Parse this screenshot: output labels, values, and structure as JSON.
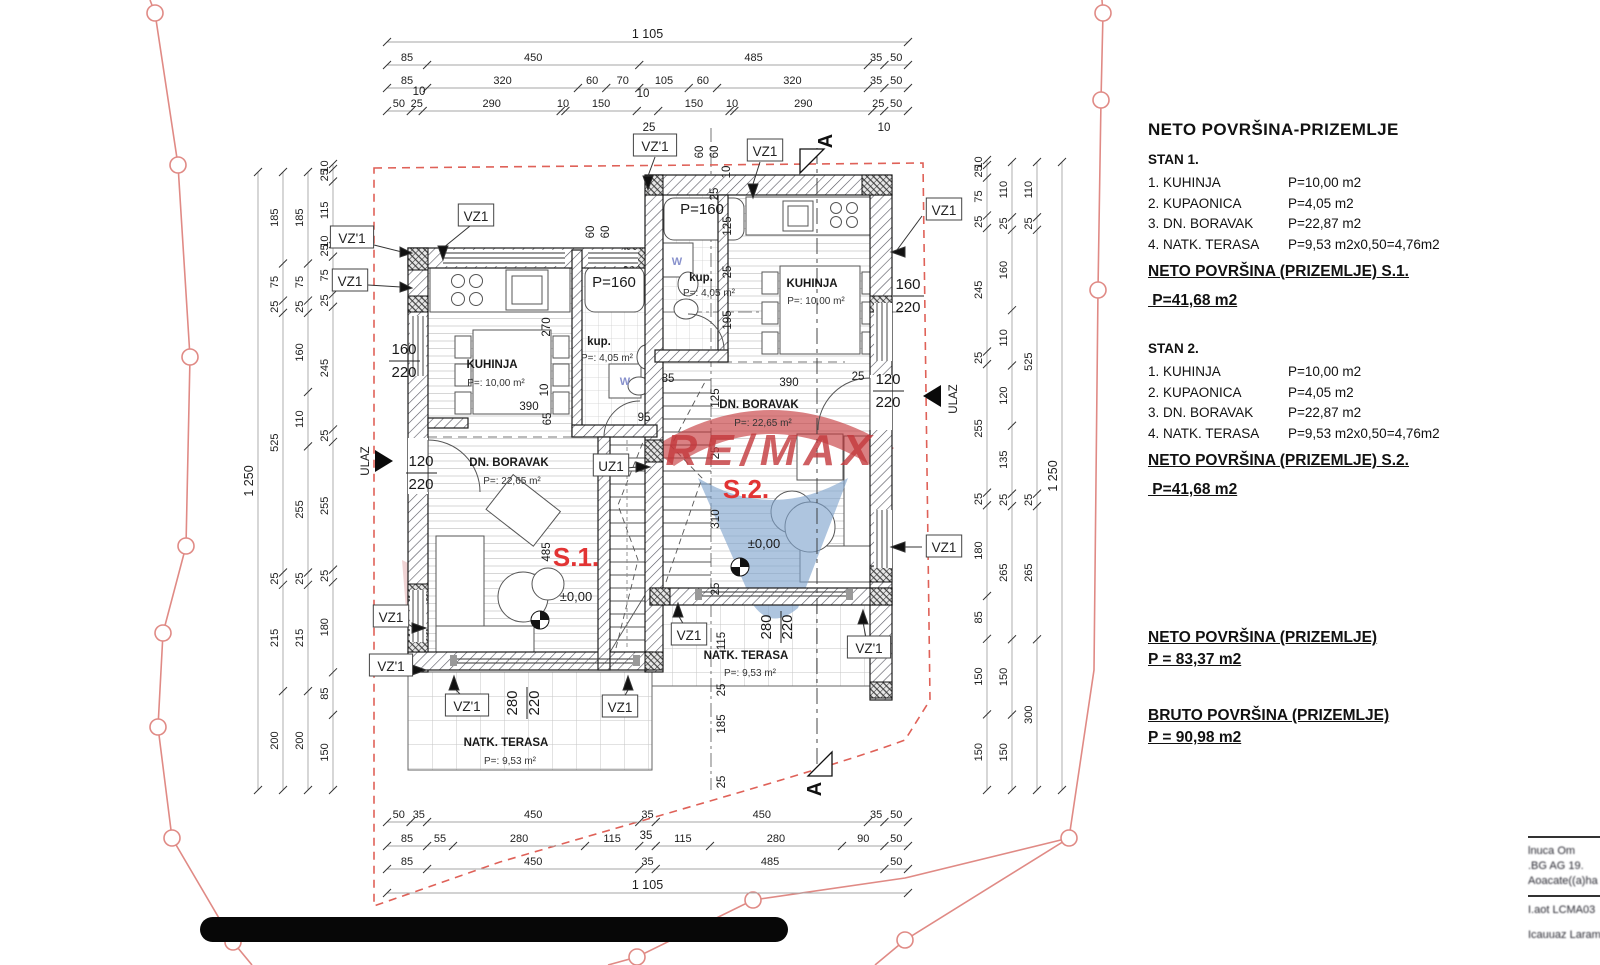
{
  "panel": {
    "heading": "NETO  POVRŠINA-PRIZEMLJE",
    "stan1": {
      "title": "STAN 1.",
      "rows": [
        {
          "name": "1. KUHINJA",
          "value": "P=10,00 m2"
        },
        {
          "name": "2. KUPAONICA",
          "value": "P=4,05 m2"
        },
        {
          "name": "3. DN. BORAVAK",
          "value": "P=22,87 m2"
        },
        {
          "name": "4. NATK. TERASA",
          "value": "P=9,53 m2x0,50=4,76m2"
        }
      ],
      "sum_label": "NETO POVRŠINA (PRIZEMLJE) S.1.",
      "sum_value": " P=41,68 m2"
    },
    "stan2": {
      "title": "STAN 2.",
      "rows": [
        {
          "name": "1. KUHINJA",
          "value": "P=10,00 m2"
        },
        {
          "name": "2. KUPAONICA",
          "value": "P=4,05 m2"
        },
        {
          "name": "3. DN. BORAVAK",
          "value": "P=22,87 m2"
        },
        {
          "name": "4. NATK. TERASA",
          "value": "P=9,53 m2x0,50=4,76m2"
        }
      ],
      "sum_label": "NETO POVRŠINA (PRIZEMLJE) S.2.",
      "sum_value": " P=41,68 m2"
    },
    "neto_total": {
      "label": "NETO POVRŠINA (PRIZEMLJE)",
      "value": "P = 83,37 m2"
    },
    "bruto_total": {
      "label": "BRUTO POVRŠINA (PRIZEMLJE)",
      "value": "P = 90,98 m2"
    }
  },
  "titleblock": {
    "lines": [
      "lnuca  Om",
      ".BG AG 19.",
      "Aoacate((a)ha",
      "I.aot LCMA03",
      "Icauuaz  Laram"
    ]
  },
  "watermark": {
    "text": "RE/MAX",
    "red": "#c4393c",
    "blue": "#7fa3cd"
  },
  "plan_labels": [
    {
      "t": "VZ'1",
      "x": 352,
      "y": 238,
      "c": "box"
    },
    {
      "t": "VZ1",
      "x": 350,
      "y": 281,
      "c": "box"
    },
    {
      "t": "VZ1",
      "x": 476,
      "y": 216,
      "c": "box"
    },
    {
      "t": "VZ'1",
      "x": 655,
      "y": 146,
      "c": "box"
    },
    {
      "t": "VZ1",
      "x": 765,
      "y": 151,
      "c": "box"
    },
    {
      "t": "VZ1",
      "x": 944,
      "y": 210,
      "c": "box"
    },
    {
      "t": "VZ1",
      "x": 944,
      "y": 547,
      "c": "box"
    },
    {
      "t": "VZ1",
      "x": 391,
      "y": 617,
      "c": "box"
    },
    {
      "t": "VZ'1",
      "x": 391,
      "y": 666,
      "c": "box"
    },
    {
      "t": "VZ'1",
      "x": 467,
      "y": 706,
      "c": "box"
    },
    {
      "t": "VZ1",
      "x": 620,
      "y": 707,
      "c": "box"
    },
    {
      "t": "VZ1",
      "x": 689,
      "y": 635,
      "c": "box"
    },
    {
      "t": "VZ'1",
      "x": 869,
      "y": 648,
      "c": "box"
    },
    {
      "t": "UZ1",
      "x": 611,
      "y": 466,
      "c": "box"
    },
    {
      "t": "KUHINJA",
      "x": 492,
      "y": 368,
      "c": "room"
    },
    {
      "t": "P=: 10,00 m²",
      "x": 496,
      "y": 386,
      "c": "small"
    },
    {
      "t": "KUHINJA",
      "x": 812,
      "y": 287,
      "c": "room"
    },
    {
      "t": "P=: 10,00 m²",
      "x": 816,
      "y": 304,
      "c": "small"
    },
    {
      "t": "kup.",
      "x": 599,
      "y": 345,
      "c": "room"
    },
    {
      "t": "P=: 4,05 m²",
      "x": 607,
      "y": 361,
      "c": "small"
    },
    {
      "t": "kup.",
      "x": 701,
      "y": 281,
      "c": "room"
    },
    {
      "t": "P=: 4,05 m²",
      "x": 709,
      "y": 296,
      "c": "small"
    },
    {
      "t": "DN. BORAVAK",
      "x": 509,
      "y": 466,
      "c": "room"
    },
    {
      "t": "P=:   22,65 m²",
      "x": 512,
      "y": 484,
      "c": "small"
    },
    {
      "t": "DN. BORAVAK",
      "x": 759,
      "y": 408,
      "c": "room"
    },
    {
      "t": "P=:    22,65 m²",
      "x": 763,
      "y": 426,
      "c": "small"
    },
    {
      "t": "NATK. TERASA",
      "x": 506,
      "y": 746,
      "c": "room"
    },
    {
      "t": "P=:      9,53 m²",
      "x": 510,
      "y": 764,
      "c": "small"
    },
    {
      "t": "NATK. TERASA",
      "x": 746,
      "y": 659,
      "c": "room"
    },
    {
      "t": "P=:      9,53 m²",
      "x": 750,
      "y": 676,
      "c": "small"
    },
    {
      "t": "P=160",
      "x": 614,
      "y": 287,
      "c": "frac"
    },
    {
      "t": "P=160",
      "x": 702,
      "y": 214,
      "c": "frac"
    },
    {
      "t": "±0,00",
      "x": 576,
      "y": 601,
      "c": "level"
    },
    {
      "t": "±0,00",
      "x": 764,
      "y": 548,
      "c": "level"
    },
    {
      "t": "S.1.",
      "x": 576,
      "y": 566,
      "c": "red"
    },
    {
      "t": "S.2.",
      "x": 746,
      "y": 498,
      "c": "red"
    },
    {
      "t": "60",
      "x": 594,
      "y": 232,
      "r": -90,
      "c": "dim"
    },
    {
      "t": "60",
      "x": 609,
      "y": 232,
      "r": -90,
      "c": "dim"
    },
    {
      "t": "60",
      "x": 703,
      "y": 152,
      "r": -90,
      "c": "dim"
    },
    {
      "t": "60",
      "x": 718,
      "y": 152,
      "r": -90,
      "c": "dim"
    },
    {
      "t": "10",
      "x": 730,
      "y": 172,
      "r": -90,
      "c": "dim"
    },
    {
      "t": "25",
      "x": 718,
      "y": 194,
      "r": -90,
      "c": "dim"
    },
    {
      "t": "270",
      "x": 550,
      "y": 327,
      "r": -90,
      "c": "dim"
    },
    {
      "t": "10",
      "x": 548,
      "y": 390,
      "r": -90,
      "c": "dim"
    },
    {
      "t": "390",
      "x": 529,
      "y": 410,
      "c": "dim"
    },
    {
      "t": "65",
      "x": 551,
      "y": 419,
      "r": -90,
      "c": "dim"
    },
    {
      "t": "125",
      "x": 731,
      "y": 226,
      "r": -90,
      "c": "dim"
    },
    {
      "t": "25",
      "x": 731,
      "y": 272,
      "r": -90,
      "c": "dim"
    },
    {
      "t": "195",
      "x": 731,
      "y": 320,
      "r": -90,
      "c": "dim"
    },
    {
      "t": "85",
      "x": 668,
      "y": 382,
      "c": "dim"
    },
    {
      "t": "95",
      "x": 644,
      "y": 421,
      "c": "dim"
    },
    {
      "t": "390",
      "x": 789,
      "y": 386,
      "c": "dim"
    },
    {
      "t": "25",
      "x": 858,
      "y": 380,
      "c": "dim"
    },
    {
      "t": "125",
      "x": 719,
      "y": 398,
      "r": -90,
      "c": "dim"
    },
    {
      "t": "25",
      "x": 719,
      "y": 453,
      "r": -90,
      "c": "dim"
    },
    {
      "t": "310",
      "x": 719,
      "y": 519,
      "r": -90,
      "c": "dim"
    },
    {
      "t": "25",
      "x": 719,
      "y": 589,
      "r": -90,
      "c": "dim"
    },
    {
      "t": "485",
      "x": 550,
      "y": 552,
      "r": -90,
      "c": "dim"
    },
    {
      "t": "115",
      "x": 725,
      "y": 641,
      "r": -90,
      "c": "dim"
    },
    {
      "t": "25",
      "x": 725,
      "y": 690,
      "r": -90,
      "c": "dim"
    },
    {
      "t": "185",
      "x": 725,
      "y": 724,
      "r": -90,
      "c": "dim"
    },
    {
      "t": "25",
      "x": 725,
      "y": 782,
      "r": -90,
      "c": "dim"
    },
    {
      "t": "280",
      "x": 517,
      "y": 703,
      "r": -90,
      "c": "frac"
    },
    {
      "t": "220",
      "x": 539,
      "y": 703,
      "r": -90,
      "c": "frac"
    },
    {
      "t": "280",
      "x": 771,
      "y": 627,
      "r": -90,
      "c": "frac"
    },
    {
      "t": "220",
      "x": 792,
      "y": 627,
      "r": -90,
      "c": "frac"
    },
    {
      "t": "160",
      "x": 404,
      "y": 354,
      "c": "frac"
    },
    {
      "t": "220",
      "x": 404,
      "y": 377,
      "c": "frac"
    },
    {
      "t": "120",
      "x": 421,
      "y": 466,
      "c": "frac"
    },
    {
      "t": "220",
      "x": 421,
      "y": 489,
      "c": "frac"
    },
    {
      "t": "160",
      "x": 908,
      "y": 289,
      "c": "frac"
    },
    {
      "t": "220",
      "x": 908,
      "y": 312,
      "c": "frac"
    },
    {
      "t": "120",
      "x": 888,
      "y": 384,
      "c": "frac"
    },
    {
      "t": "220",
      "x": 888,
      "y": 407,
      "c": "frac"
    },
    {
      "t": "ULAZ",
      "x": 369,
      "y": 461,
      "r": -90,
      "c": "dim"
    },
    {
      "t": "ULAZ",
      "x": 957,
      "y": 399,
      "r": -90,
      "c": "dim"
    },
    {
      "t": "A",
      "x": 832,
      "y": 141,
      "r": -90,
      "c": "axis"
    },
    {
      "t": "A",
      "x": 821,
      "y": 789,
      "r": -90,
      "c": "axis"
    },
    {
      "t": "10",
      "x": 419,
      "y": 95,
      "c": "dim"
    },
    {
      "t": "10",
      "x": 643,
      "y": 97,
      "c": "dim"
    },
    {
      "t": "25",
      "x": 649,
      "y": 131,
      "c": "dim"
    },
    {
      "t": "10",
      "x": 884,
      "y": 131,
      "c": "dim"
    },
    {
      "t": "35",
      "x": 646,
      "y": 839,
      "c": "dim"
    },
    {
      "t": "W",
      "x": 625,
      "y": 385,
      "c": "wash"
    },
    {
      "t": "W",
      "x": 677,
      "y": 265,
      "c": "wash"
    },
    {
      "t": "RE/MAX",
      "x": 772,
      "y": 465,
      "c": "wm"
    }
  ],
  "dim_chains": [
    {
      "o": "h",
      "x1": 387,
      "x2": 908,
      "y": 42,
      "parts": [
        [
          1105,
          "1 105"
        ]
      ]
    },
    {
      "o": "h",
      "x1": 387,
      "x2": 908,
      "y": 65,
      "parts": [
        [
          85,
          "85"
        ],
        [
          450,
          "450"
        ],
        [
          485,
          "485"
        ],
        [
          35,
          "35"
        ],
        [
          50,
          "50"
        ]
      ]
    },
    {
      "o": "h",
      "x1": 387,
      "x2": 908,
      "y": 88,
      "parts": [
        [
          85,
          "85"
        ],
        [
          320,
          "320"
        ],
        [
          60,
          "60"
        ],
        [
          70,
          "70"
        ],
        [
          105,
          "105"
        ],
        [
          60,
          "60"
        ],
        [
          320,
          "320"
        ],
        [
          35,
          "35"
        ],
        [
          50,
          "50"
        ]
      ]
    },
    {
      "o": "h",
      "x1": 387,
      "x2": 908,
      "y": 111,
      "parts": [
        [
          50,
          "50"
        ],
        [
          25,
          "25"
        ],
        [
          290,
          "290"
        ],
        [
          10,
          "10"
        ],
        [
          150,
          "150"
        ],
        [
          45,
          ""
        ],
        [
          150,
          "150"
        ],
        [
          10,
          "10"
        ],
        [
          290,
          "290"
        ],
        [
          25,
          "25"
        ],
        [
          50,
          "50"
        ]
      ]
    },
    {
      "o": "h",
      "x1": 387,
      "x2": 908,
      "y": 822,
      "parts": [
        [
          50,
          "50"
        ],
        [
          35,
          "35"
        ],
        [
          450,
          "450"
        ],
        [
          35,
          "35"
        ],
        [
          450,
          "450"
        ],
        [
          35,
          "35"
        ],
        [
          50,
          "50"
        ]
      ]
    },
    {
      "o": "h",
      "x1": 387,
      "x2": 908,
      "y": 846,
      "parts": [
        [
          85,
          "85"
        ],
        [
          55,
          "55"
        ],
        [
          280,
          "280"
        ],
        [
          115,
          "115"
        ],
        [
          35,
          ""
        ],
        [
          115,
          "115"
        ],
        [
          280,
          "280"
        ],
        [
          90,
          "90"
        ],
        [
          50,
          "50"
        ]
      ]
    },
    {
      "o": "h",
      "x1": 387,
      "x2": 908,
      "y": 869,
      "parts": [
        [
          85,
          "85"
        ],
        [
          450,
          "450"
        ],
        [
          35,
          "35"
        ],
        [
          485,
          "485"
        ],
        [
          50,
          "50"
        ]
      ]
    },
    {
      "o": "h",
      "x1": 387,
      "x2": 908,
      "y": 893,
      "parts": [
        [
          1105,
          "1 105"
        ]
      ]
    },
    {
      "o": "v",
      "x": 258,
      "y1": 172,
      "y2": 790,
      "parts": [
        [
          1250,
          "1 250"
        ]
      ]
    },
    {
      "o": "v",
      "x": 283,
      "y1": 172,
      "y2": 790,
      "parts": [
        [
          185,
          "185"
        ],
        [
          75,
          "75"
        ],
        [
          25,
          "25"
        ],
        [
          525,
          "525"
        ],
        [
          25,
          "25"
        ],
        [
          215,
          "215"
        ],
        [
          200,
          "200"
        ]
      ]
    },
    {
      "o": "v",
      "x": 308,
      "y1": 172,
      "y2": 790,
      "parts": [
        [
          185,
          "185"
        ],
        [
          75,
          "75"
        ],
        [
          25,
          "25"
        ],
        [
          160,
          "160"
        ],
        [
          110,
          "110"
        ],
        [
          255,
          "255"
        ],
        [
          25,
          "25"
        ],
        [
          215,
          "215"
        ],
        [
          200,
          "200"
        ]
      ]
    },
    {
      "o": "v",
      "x": 333,
      "y1": 164,
      "y2": 790,
      "parts": [
        [
          10,
          "10"
        ],
        [
          25,
          "25"
        ],
        [
          115,
          "115"
        ],
        [
          10,
          "10"
        ],
        [
          25,
          "25"
        ],
        [
          75,
          "75"
        ],
        [
          25,
          "25"
        ],
        [
          245,
          "245"
        ],
        [
          25,
          "25"
        ],
        [
          255,
          "255"
        ],
        [
          25,
          "25"
        ],
        [
          180,
          "180"
        ],
        [
          85,
          "85"
        ],
        [
          150,
          "150"
        ]
      ]
    },
    {
      "o": "v",
      "x": 987,
      "y1": 160,
      "y2": 790,
      "parts": [
        [
          10,
          "10"
        ],
        [
          25,
          "25"
        ],
        [
          75,
          "75"
        ],
        [
          25,
          "25"
        ],
        [
          245,
          "245"
        ],
        [
          25,
          "25"
        ],
        [
          255,
          "255"
        ],
        [
          25,
          "25"
        ],
        [
          180,
          "180"
        ],
        [
          85,
          "85"
        ],
        [
          150,
          "150"
        ],
        [
          150,
          "150"
        ]
      ]
    },
    {
      "o": "v",
      "x": 1012,
      "y1": 162,
      "y2": 790,
      "parts": [
        [
          110,
          "110"
        ],
        [
          25,
          "25"
        ],
        [
          160,
          "160"
        ],
        [
          110,
          "110"
        ],
        [
          120,
          "120"
        ],
        [
          135,
          "135"
        ],
        [
          25,
          "25"
        ],
        [
          265,
          "265"
        ],
        [
          150,
          "150"
        ],
        [
          150,
          "150"
        ]
      ]
    },
    {
      "o": "v",
      "x": 1037,
      "y1": 162,
      "y2": 790,
      "parts": [
        [
          110,
          "110"
        ],
        [
          25,
          "25"
        ],
        [
          525,
          "525"
        ],
        [
          25,
          "25"
        ],
        [
          265,
          "265"
        ],
        [
          300,
          "300"
        ]
      ]
    },
    {
      "o": "v",
      "x": 1062,
      "y1": 162,
      "y2": 790,
      "parts": [
        [
          1250,
          "1 250"
        ]
      ]
    }
  ]
}
